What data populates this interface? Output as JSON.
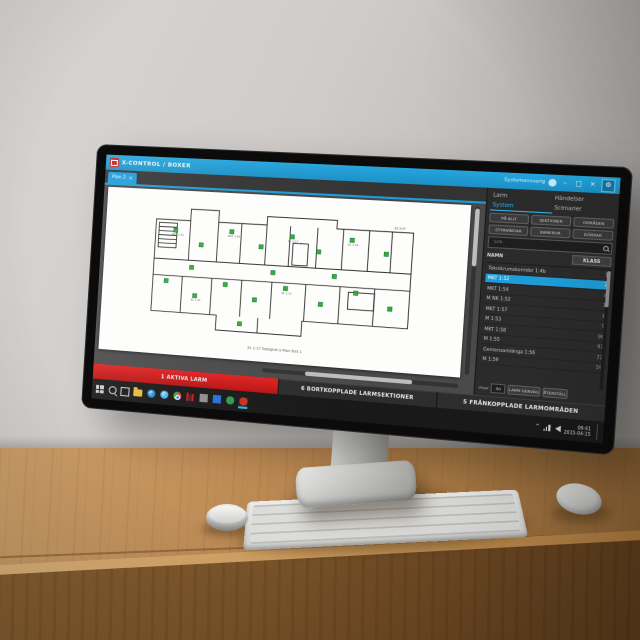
{
  "colors": {
    "accent_blue": "#1e9cd8",
    "alarm_red": "#d11a1a",
    "sensor_green": "#2fae3f"
  },
  "app": {
    "title": "X-CONTROL / BOXER",
    "user_label": "Systemansvarig",
    "window_controls": {
      "minimize": "–",
      "maximize": "□",
      "close": "×"
    },
    "plan_tab": {
      "label": "Plan 2",
      "close": "×"
    },
    "plan_note": "62 KVT",
    "plan_caption": "KL 1:17 Fastighet o Plan Text 1",
    "plan_sensor_labels": [
      "MKT 1:52",
      "MKT 1:54",
      "KL 1:12",
      "KL 1:14",
      "KL 1:21",
      "KL 1:32"
    ],
    "panel": {
      "tabs": [
        {
          "label": "Larm"
        },
        {
          "label": "Händelser"
        },
        {
          "label": "System"
        },
        {
          "label": "Scenarier"
        }
      ],
      "filters": [
        "PÅ ALLT",
        "SEKTIONER",
        "OMRÅDEN",
        "STYRNINGAR",
        "KAMEROR",
        "DÖRRAR"
      ],
      "search_placeholder": "Sök",
      "columns": [
        "NAMN",
        "KLASS"
      ],
      "rows": [
        {
          "name": "Teknikrumskorridor 1:4b",
          "klass": "1"
        },
        {
          "name": "MKT 1:52",
          "klass": "2"
        },
        {
          "name": "MKT 1:54",
          "klass": "4"
        },
        {
          "name": "M NK 1:52",
          "klass": "1"
        },
        {
          "name": "MKT 1:57",
          "klass": "6"
        },
        {
          "name": "M 1:53",
          "klass": "9"
        },
        {
          "name": "MKT 1:58",
          "klass": "96"
        },
        {
          "name": "M 1:55",
          "klass": "97"
        },
        {
          "name": "Gemensamlänga 1:56",
          "klass": "72"
        },
        {
          "name": "M 1:59",
          "klass": "59"
        }
      ],
      "footer": {
        "visar_label": "Visar",
        "page_size": "50",
        "shortcut_button": "LARM GENVÄG",
        "reset_button": "ÅTERSTÄLL"
      }
    },
    "statusbar": {
      "active_alarms": "1 AKTIVA LARM",
      "disconnected_sections": "6 BORTKOPPLADE LARMSEKTIONER",
      "disarmed_areas": "5 FRÅNKOPPLADE LARMOMRÅDEN"
    }
  },
  "taskbar": {
    "clock_time": "09:41",
    "clock_date": "2015-04-15"
  }
}
